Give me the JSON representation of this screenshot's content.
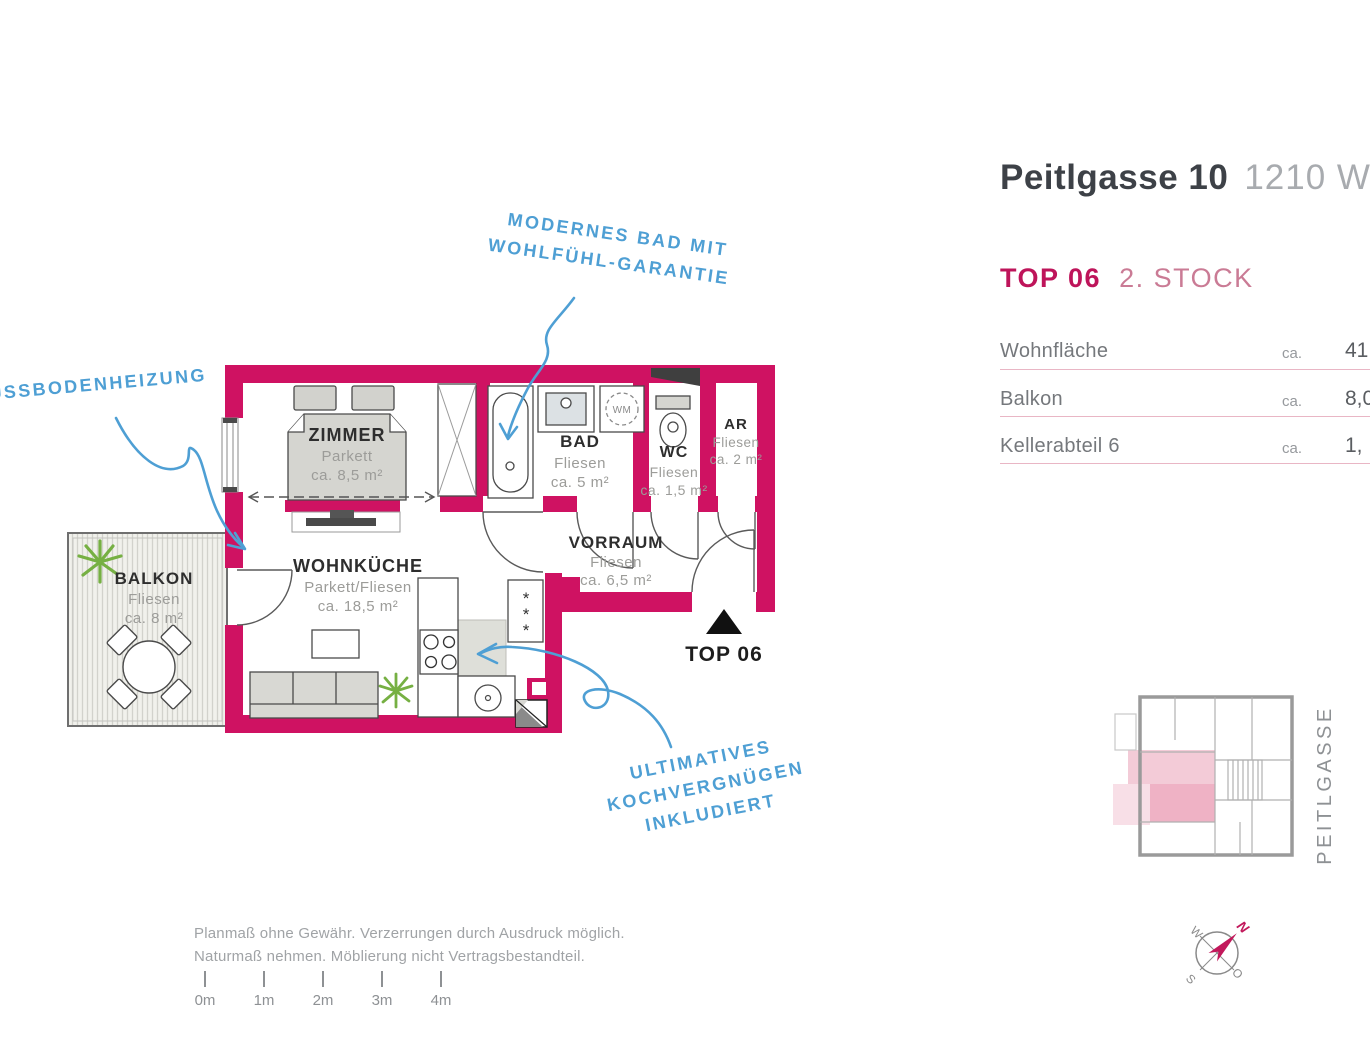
{
  "header": {
    "building": "Peitlgasse 10",
    "district": "1210 Wien",
    "unit": "TOP 06",
    "floor": "2. STOCK"
  },
  "area_table": {
    "rows": [
      {
        "label": "Wohnfläche",
        "approx": "ca.",
        "value": "41,"
      },
      {
        "label": "Balkon",
        "approx": "ca.",
        "value": "8,0"
      },
      {
        "label": "Kellerabteil 6",
        "approx": "ca.",
        "value": "1,"
      }
    ]
  },
  "rooms": {
    "zimmer": {
      "name": "ZIMMER",
      "finish": "Parkett",
      "area": "ca. 8,5 m²"
    },
    "bad": {
      "name": "BAD",
      "finish": "Fliesen",
      "area": "ca. 5 m²"
    },
    "wc": {
      "name": "WC",
      "finish": "Fliesen",
      "area": "ca. 1,5 m²"
    },
    "ar": {
      "name": "AR",
      "finish": "Fliesen",
      "area": "ca. 2 m²"
    },
    "vorraum": {
      "name": "VORRAUM",
      "finish": "Fliesen",
      "area": "ca. 6,5 m²"
    },
    "wohnkueche": {
      "name": "WOHNKÜCHE",
      "finish": "Parkett/Fliesen",
      "area": "ca. 18,5 m²"
    },
    "balkon": {
      "name": "BALKON",
      "finish": "Fliesen",
      "area": "ca. 8 m²"
    }
  },
  "plan": {
    "entrance_label": "TOP 06",
    "wm_label": "WM",
    "freezer_star": "*"
  },
  "annotations": {
    "bathroom": {
      "line1": "MODERNES BAD MIT",
      "line2": "WOHLFÜHL-GARANTIE"
    },
    "heating": {
      "line1": "FUSSBODENHEIZUNG"
    },
    "kitchen": {
      "line1": "ULTIMATIVES",
      "line2": "KOCHVERGNÜGEN",
      "line3": "INKLUDIERT"
    }
  },
  "footer": {
    "disclaimer1": "Planmaß ohne Gewähr. Verzerrungen durch Ausdruck möglich.",
    "disclaimer2": "Naturmaß nehmen. Möblierung nicht Vertragsbestandteil.",
    "scale_labels": [
      "0m",
      "1m",
      "2m",
      "3m",
      "4m"
    ]
  },
  "site_plan": {
    "street": "PEITLGASSE",
    "compass": {
      "n": "N",
      "o": "O",
      "s": "S",
      "w": "W"
    }
  },
  "colors": {
    "wall": "#cf1262",
    "accent": "#be145a",
    "annotation_blue": "#4e9fd4",
    "table_underline": "#e9b6c5"
  }
}
